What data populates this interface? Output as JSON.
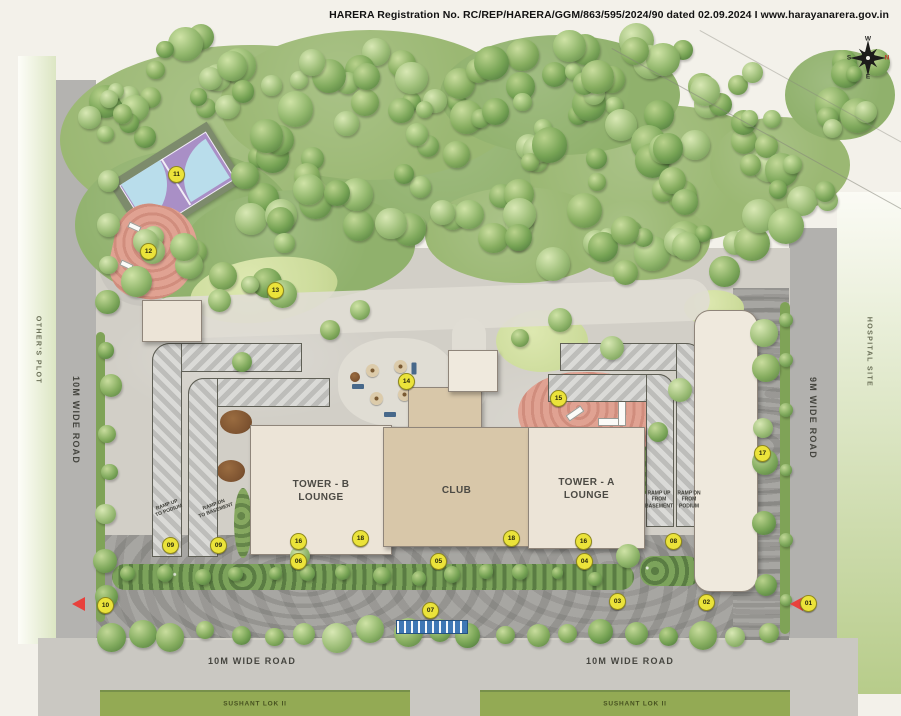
{
  "header": {
    "registration_line": "HARERA Registration No. RC/REP/HARERA/GGM/863/595/2024/90 dated 02.09.2024 I www.harayanarera.gov.in"
  },
  "compass": {
    "north": "N",
    "south": "S",
    "east": "E",
    "west": "W"
  },
  "roads": {
    "left_label": "10M WIDE ROAD",
    "right_label": "9M WIDE ROAD",
    "bottom_left_label": "10M WIDE ROAD",
    "bottom_right_label": "10M WIDE ROAD"
  },
  "surroundings": {
    "others_plot": "OTHER'S PLOT",
    "hospital_site": "HOSPITAL SITE",
    "sushant_left": "SUSHANT LOK II",
    "sushant_right": "SUSHANT LOK II"
  },
  "buildings": {
    "tower_b": {
      "line1": "TOWER - B",
      "line2": "LOUNGE"
    },
    "tower_a": {
      "line1": "TOWER - A",
      "line2": "LOUNGE"
    },
    "club": "CLUB"
  },
  "ramps": {
    "left_up": [
      "RAMP UP",
      "TO PODIUM"
    ],
    "left_down": [
      "RAMP DN",
      "TO BASEMENT"
    ],
    "right_up": [
      "RAMP UP",
      "FROM",
      "BASEMENT"
    ],
    "right_down": [
      "RAMP DN",
      "FROM",
      "PODIUM"
    ]
  },
  "markers": [
    {
      "label": "01",
      "x": 808,
      "y": 603
    },
    {
      "label": "02",
      "x": 706,
      "y": 602
    },
    {
      "label": "03",
      "x": 617,
      "y": 601
    },
    {
      "label": "04",
      "x": 584,
      "y": 561
    },
    {
      "label": "05",
      "x": 438,
      "y": 561
    },
    {
      "label": "06",
      "x": 298,
      "y": 561
    },
    {
      "label": "07",
      "x": 430,
      "y": 610
    },
    {
      "label": "08",
      "x": 673,
      "y": 541
    },
    {
      "label": "09",
      "x": 170,
      "y": 545
    },
    {
      "label": "09",
      "x": 218,
      "y": 545
    },
    {
      "label": "10",
      "x": 105,
      "y": 605
    },
    {
      "label": "11",
      "x": 176,
      "y": 174
    },
    {
      "label": "12",
      "x": 148,
      "y": 251
    },
    {
      "label": "13",
      "x": 275,
      "y": 290
    },
    {
      "label": "14",
      "x": 406,
      "y": 381
    },
    {
      "label": "15",
      "x": 558,
      "y": 398
    },
    {
      "label": "16",
      "x": 298,
      "y": 541
    },
    {
      "label": "16",
      "x": 583,
      "y": 541
    },
    {
      "label": "17",
      "x": 762,
      "y": 453
    },
    {
      "label": "18",
      "x": 360,
      "y": 538
    },
    {
      "label": "18",
      "x": 511,
      "y": 538
    }
  ],
  "colors": {
    "marker_bg": "#ebe33a",
    "marker_border": "#8f891e",
    "arrow_red": "#e8413c",
    "compass_north_red": "#c0392b",
    "water_blue": "#3e77b5",
    "forest_green": "#8fb56a",
    "lawn_green": "#cddc9c",
    "road_gray": "#b4b3b0",
    "building_beige": "#ece4d7",
    "club_tan": "#d8c7a9",
    "play_pink": "#e0a292",
    "court_purple": "#a98fc6",
    "court_blue": "#b9ddeb"
  }
}
